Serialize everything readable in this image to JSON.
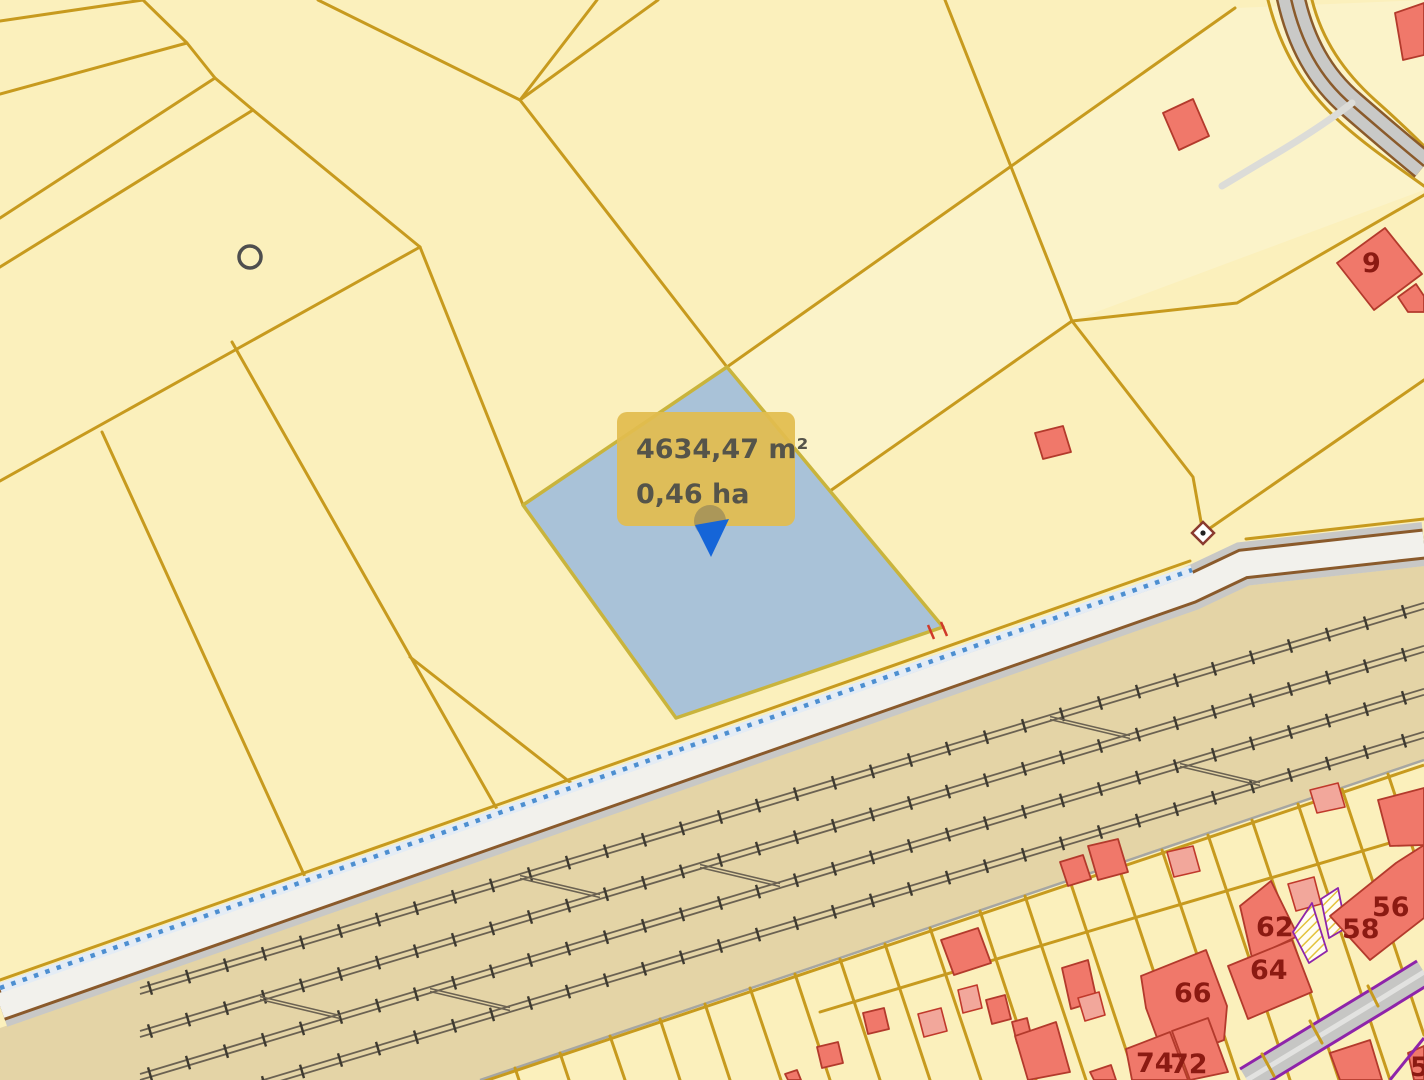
{
  "app": {
    "name": "cadastral-map-viewer"
  },
  "selected_parcel": {
    "area_m2_label": "4634,47 m²",
    "area_ha_label": "0,46 ha"
  },
  "house_numbers": [
    {
      "text": "9"
    },
    {
      "text": "56"
    },
    {
      "text": "58"
    },
    {
      "text": "62"
    },
    {
      "text": "64"
    },
    {
      "text": "66"
    },
    {
      "text": "74"
    },
    {
      "text": "72"
    },
    {
      "text": "5"
    }
  ],
  "colors": {
    "parcel_fill": "#FBF0BC",
    "parcel_border": "#C79A1E",
    "selected_parcel_fill": "#9DBBDC",
    "railway_fill": "#E4D4A6",
    "road_surface": "#F2F1EC",
    "road_edge_brown": "#8A5A2B",
    "cycleway_dots_blue": "#4D8FD1",
    "building_fill": "#F0786A",
    "building_border": "#B33A2C",
    "house_number_red": "#8B1A12",
    "tooltip_fill": "#E2BC4F",
    "street_edge_purple": "#8E24AA",
    "marker_blue": "#1565D8"
  }
}
